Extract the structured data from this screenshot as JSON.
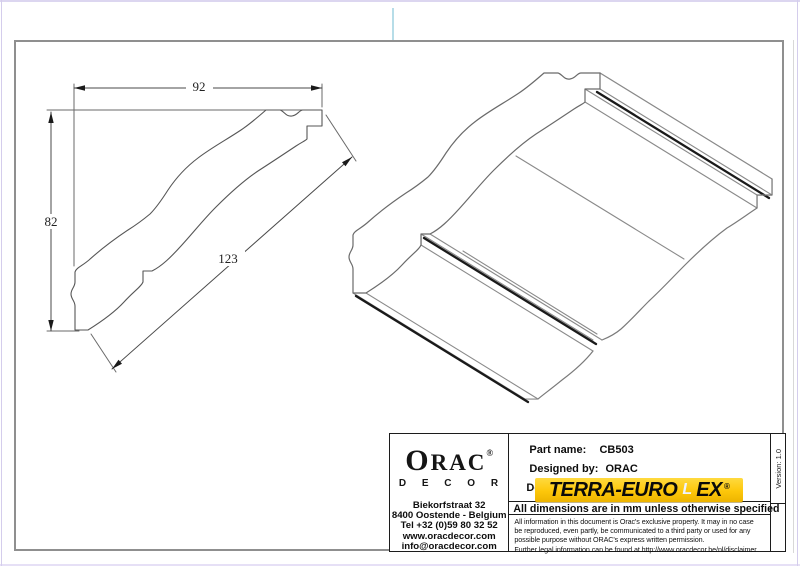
{
  "drawing": {
    "dim_width_mm": "92",
    "dim_height_mm": "82",
    "dim_face_mm": "123"
  },
  "title_block": {
    "logo": {
      "brand_o": "O",
      "brand_rac": "RAC",
      "reg": "®",
      "sub": "D E C O R"
    },
    "address": {
      "line1": "Biekorfstraat 32",
      "line2": "8400 Oostende - Belgium",
      "line3": "Tel  +32 (0)59 80 32 52",
      "line4": "www.oracdecor.com",
      "line5": "info@oracdecor.com"
    },
    "fields": {
      "part_label": "Part name:",
      "part_value": "CB503",
      "designed_label": "Designed by:",
      "designed_value": "ORAC",
      "partial_line": "De"
    },
    "banner": {
      "text_left": "TERRA-EURO",
      "text_l": "L",
      "text_right": "EX",
      "reg": "®"
    },
    "dimensions_note": "All dimensions are in mm unless otherwise specified",
    "legal": {
      "line1": "All information in this document is Orac's exclusive property.  It may in no case",
      "line2": "be reproduced, even partly, be communicated to a third party or used for any",
      "line3": "possible purpose without ORAC's express written permission.",
      "line4": "Further legal information can be found at http://www.oracdecor.be/nl/disclaimer"
    },
    "version": "Version: 1.0"
  }
}
